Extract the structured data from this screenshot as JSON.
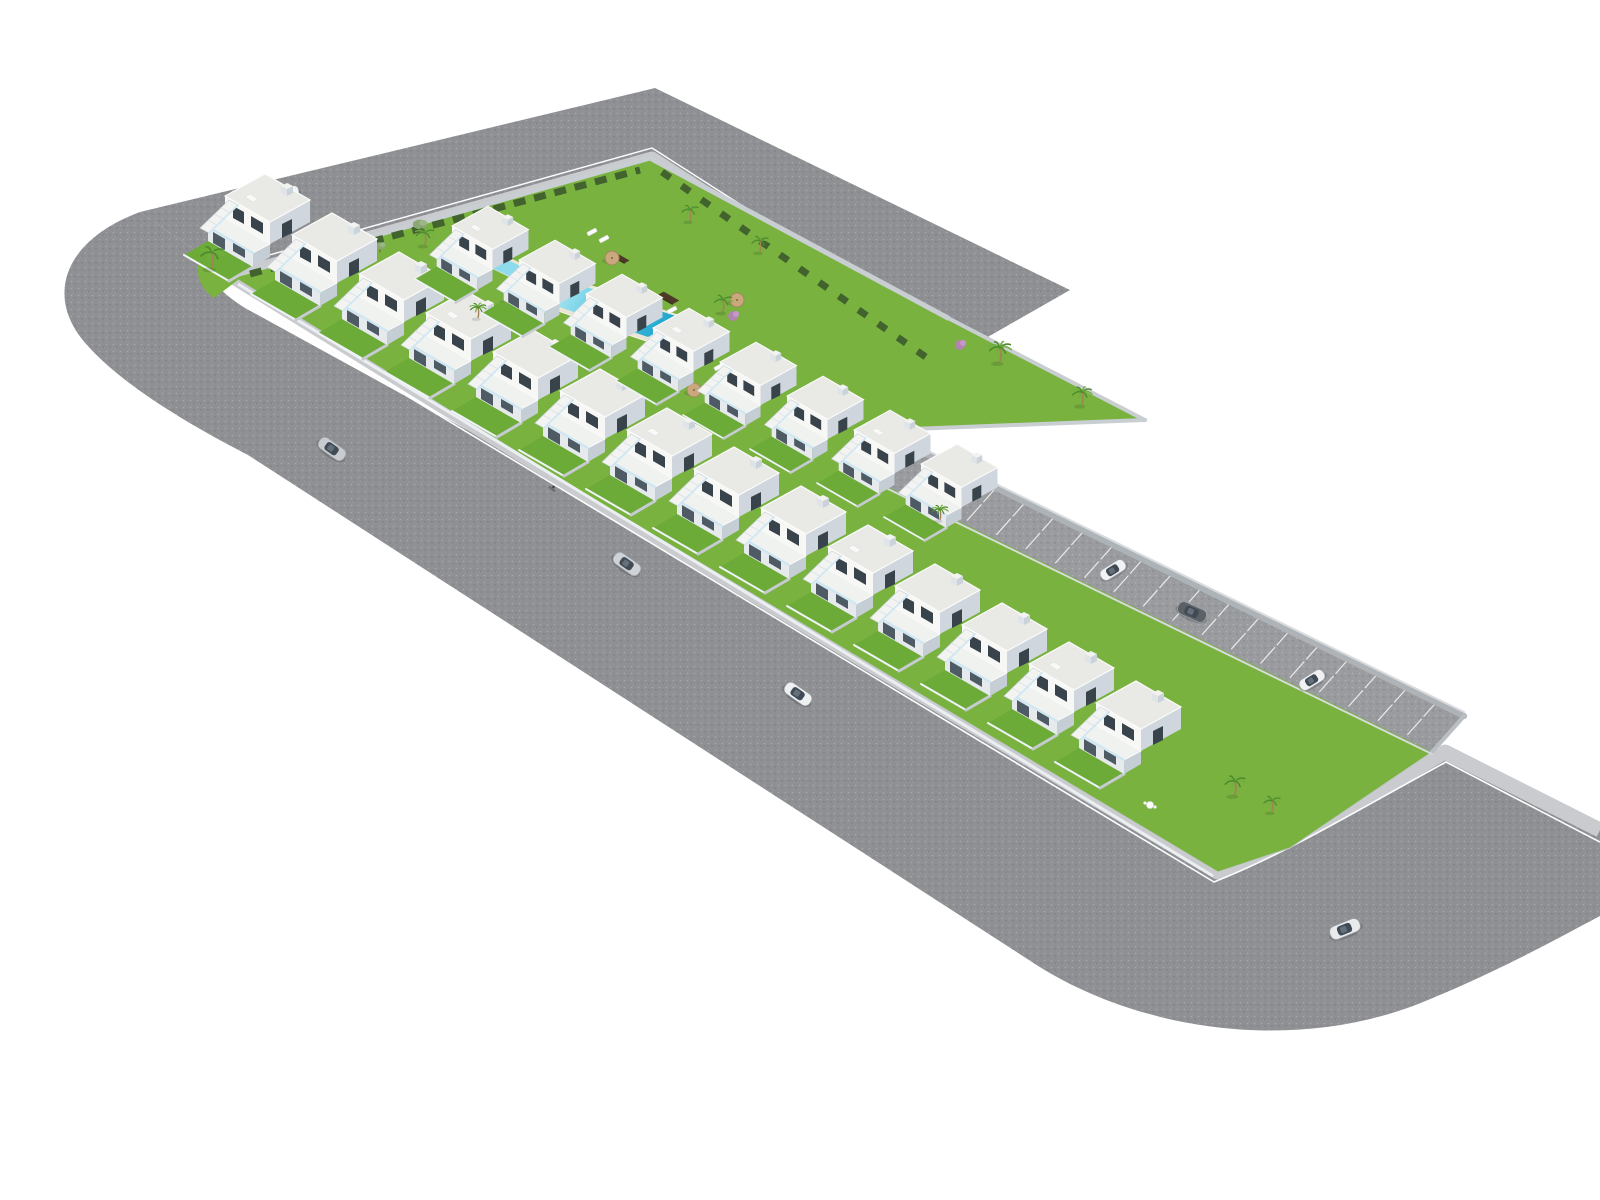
{
  "meta": {
    "description": "Aerial 3D architectural rendering of a white townhouse residential development with central garden, swimming pool, parking lane and surrounding L-shaped asphalt road",
    "image_type": "architectural-site-render",
    "visible_text": "none"
  },
  "canvas": {
    "width": 1600,
    "height": 1200,
    "background": "#ffffff"
  },
  "palette": {
    "asphalt": "#8e9093",
    "parkingAsphalt": "#9a9b9e",
    "sidewalk": "#c9cbce",
    "curb": "#fdfdfd",
    "lawn": "#79b23f",
    "lawnDark": "#6cab38",
    "hedge": "#42622e",
    "roof": "#e9eae6",
    "wallFront": "#f7f8f5",
    "wallSide": "#cfd6dd",
    "window": "#39434c",
    "slab": "#f0f2ef",
    "innerFace": "#e7eaec",
    "opening": "#4e5a64",
    "innerSide": "#c5ced5",
    "stair": "#f3f4f2",
    "glass": "#cfe7f2",
    "fence": "#eef3f6",
    "yardWall": "#c6cbd1",
    "perimeterWall": "#c9ced2",
    "stripWall": "#aeb3b8",
    "poolDeck": "#eae5d4",
    "poolStone": "#b7a57f",
    "poolLight": "#c2eff7",
    "poolMid": "#63cbe4",
    "poolDeep": "#23a8cf",
    "woodDeck": "#4c3a27",
    "umbrella": "#c8a87c",
    "umbrellaRim": "#a5875f",
    "palmGreen1": "#4e8a2e",
    "palmGreen2": "#6fb13f",
    "trunk": "#a08357",
    "oliveGreen": "#8aa872",
    "bushPink": "#b87fbe",
    "carCabin": "#404b55"
  },
  "roads": {
    "topBand": "M 140 212 L 655 88 L 1070 290 L 958 354 L 652 158 L 232 276 Z",
    "mainBand": "M 140 212 C 60 242 45 300 88 346 C 120 382 180 420 248 455 L 1032 962 C 1135 1030 1295 1056 1428 1000 C 1505 968 1562 936 1600 916 L 1600 830 L 1445 752 C 1372 794 1292 842 1218 872 L 595 500 L 245 308 Q 198 278 232 276 L 140 212 Z",
    "sidewalks": [
      {
        "d": "M 232 276 L 595 500 L 1218 872 C 1295 842 1372 794 1445 752 L 1600 830",
        "w": 15
      },
      {
        "d": "M 232 276 L 652 158 L 958 354",
        "w": 13
      }
    ],
    "curbs": [
      {
        "d": "M 226 287 L 1214 882 C 1290 852 1368 804 1446 762 L 1600 842",
        "w": 1.6
      },
      {
        "d": "M 230 266 L 652 148 L 962 346",
        "w": 1.4
      }
    ]
  },
  "site": {
    "outline": [
      [
        232,
        276
      ],
      [
        650,
        158
      ],
      [
        948,
        318
      ],
      [
        1145,
        420
      ],
      [
        877,
        430
      ],
      [
        1464,
        716
      ],
      [
        1432,
        752
      ],
      [
        1290,
        848
      ],
      [
        1218,
        872
      ],
      [
        595,
        500
      ]
    ],
    "cornerLawn": "M 200 258 Q 232 262 238 280 L 214 298 Q 192 282 200 258 Z",
    "entrance": [
      [
        556,
        468
      ],
      [
        596,
        490
      ],
      [
        588,
        497
      ],
      [
        548,
        475
      ]
    ],
    "hedges": [
      {
        "d": "M 250 274 L 640 170",
        "dash": "12 9"
      },
      {
        "d": "M 662 172 L 930 360",
        "dash": "10 14"
      }
    ],
    "walls": [
      {
        "x1": 232,
        "y1": 276,
        "x2": 650,
        "y2": 158,
        "w": 5
      },
      {
        "x1": 650,
        "y1": 158,
        "x2": 948,
        "y2": 318,
        "w": 5
      },
      {
        "x1": 948,
        "y1": 318,
        "x2": 1145,
        "y2": 420,
        "w": 4
      },
      {
        "x1": 1145,
        "y1": 420,
        "x2": 885,
        "y2": 430,
        "w": 4
      }
    ],
    "glassFence": {
      "d": "M 238 284 L 1213 876",
      "w": 3
    }
  },
  "parking": {
    "quad": [
      [
        845,
        466
      ],
      [
        1432,
        752
      ],
      [
        1464,
        716
      ],
      [
        877,
        430
      ]
    ],
    "lowerEdge": [
      [
        849,
        464
      ],
      [
        1436,
        750
      ]
    ],
    "widthVec": [
      32,
      -36
    ],
    "bays": 21,
    "wall": {
      "x1": 877,
      "y1": 430,
      "x2": 1464,
      "y2": 716,
      "w": 6
    },
    "wallTop": {
      "x1": 877,
      "y1": 426,
      "x2": 1464,
      "y2": 712,
      "w": 2
    },
    "endWalls": [
      {
        "x1": 1432,
        "y1": 752,
        "x2": 1464,
        "y2": 716,
        "w": 4
      },
      {
        "x1": 845,
        "y1": 466,
        "x2": 877,
        "y2": 430,
        "w": 4
      }
    ],
    "gate": {
      "x1": 852,
      "y1": 459,
      "x2": 864,
      "y2": 448,
      "w": 5
    },
    "lowerTrim": {
      "x1": 845,
      "y1": 468,
      "x2": 1432,
      "y2": 754,
      "w": 2
    }
  },
  "pool": {
    "deck": [
      [
        508,
        294
      ],
      [
        652,
        343
      ],
      [
        692,
        320
      ],
      [
        548,
        271
      ]
    ],
    "water": [
      [
        518,
        293
      ],
      [
        648,
        337
      ],
      [
        682,
        318
      ],
      [
        552,
        276
      ]
    ],
    "stoneWall": [
      [
        652,
        343
      ],
      [
        692,
        320
      ],
      [
        692,
        338
      ],
      [
        652,
        361
      ]
    ],
    "kidsDeck": [
      [
        482,
        264
      ],
      [
        528,
        286
      ],
      [
        548,
        276
      ],
      [
        502,
        254
      ]
    ],
    "kidsWater": [
      [
        487,
        266
      ],
      [
        527,
        284
      ],
      [
        543,
        276
      ],
      [
        503,
        258
      ]
    ],
    "grad": {
      "x1": 552,
      "y1": 276,
      "x2": 652,
      "y2": 343
    },
    "steps": [
      "M 520 291 q 6 3 12 2",
      "M 524 296 q 7 3 14 2",
      "M 528 301 q 8 3 16 2"
    ]
  },
  "woodDecks": [
    [
      513,
      305,
      10,
      4
    ],
    [
      593,
      352,
      12,
      4
    ],
    [
      668,
      298,
      9,
      4
    ],
    [
      620,
      258,
      8,
      3
    ]
  ],
  "houses": {
    "rows": [
      {
        "name": "street-row",
        "x": 225,
        "y": 196,
        "dx": 67,
        "dy": 39,
        "count": 14,
        "scale": 1.0
      },
      {
        "name": "garden-row",
        "x": 452,
        "y": 226,
        "dx": 67,
        "dy": 34,
        "count": 8,
        "scale": 0.9
      }
    ]
  },
  "vegetation": {
    "palms": [
      [
        212,
        268,
        0.95
      ],
      [
        425,
        245,
        0.75
      ],
      [
        478,
        318,
        0.65
      ],
      [
        690,
        221,
        0.7
      ],
      [
        760,
        252,
        0.7
      ],
      [
        723,
        312,
        0.75
      ],
      [
        1000,
        362,
        0.9
      ],
      [
        1082,
        405,
        0.8
      ],
      [
        940,
        520,
        0.65
      ],
      [
        1235,
        795,
        0.85
      ],
      [
        1272,
        812,
        0.7
      ]
    ],
    "olives": [
      [
        420,
        230,
        0.8
      ],
      [
        380,
        250,
        0.6
      ]
    ],
    "bushes": [
      [
        733,
        316
      ],
      [
        960,
        345
      ],
      [
        1108,
        706
      ]
    ]
  },
  "furniture": {
    "umbrellas": [
      [
        612,
        258
      ],
      [
        648,
        352
      ],
      [
        694,
        390
      ],
      [
        737,
        300
      ],
      [
        781,
        368
      ],
      [
        822,
        416
      ]
    ],
    "loungers": [
      [
        592,
        232,
        -28
      ],
      [
        604,
        239,
        -28
      ],
      [
        672,
        310,
        -28
      ],
      [
        719,
        367,
        -28
      ],
      [
        731,
        374,
        -28
      ],
      [
        800,
        430,
        -28
      ]
    ],
    "patioSet": [
      1150,
      805
    ]
  },
  "vehicles": {
    "cars": [
      {
        "x": 287,
        "y": 193,
        "r": -16,
        "c": "#f2f3f4",
        "s": 0.8
      },
      {
        "x": 332,
        "y": 449,
        "r": 35,
        "c": "#c8ccd1",
        "s": 1.0
      },
      {
        "x": 627,
        "y": 564,
        "r": 35,
        "c": "#cfd3d7",
        "s": 1.0
      },
      {
        "x": 798,
        "y": 694,
        "r": 35,
        "c": "#eef0f1",
        "s": 1.0
      },
      {
        "x": 1345,
        "y": 929,
        "r": -22,
        "c": "#e8eaec",
        "s": 1.05
      },
      {
        "x": 1113,
        "y": 570,
        "r": -32,
        "c": "#f1f2f3",
        "s": 0.92
      },
      {
        "x": 1312,
        "y": 680,
        "r": -32,
        "c": "#eff0f2",
        "s": 0.92
      },
      {
        "x": 1192,
        "y": 612,
        "r": 24,
        "c": "#5b6167",
        "s": 1.0
      }
    ],
    "scooter": [
      552,
      489
    ]
  }
}
